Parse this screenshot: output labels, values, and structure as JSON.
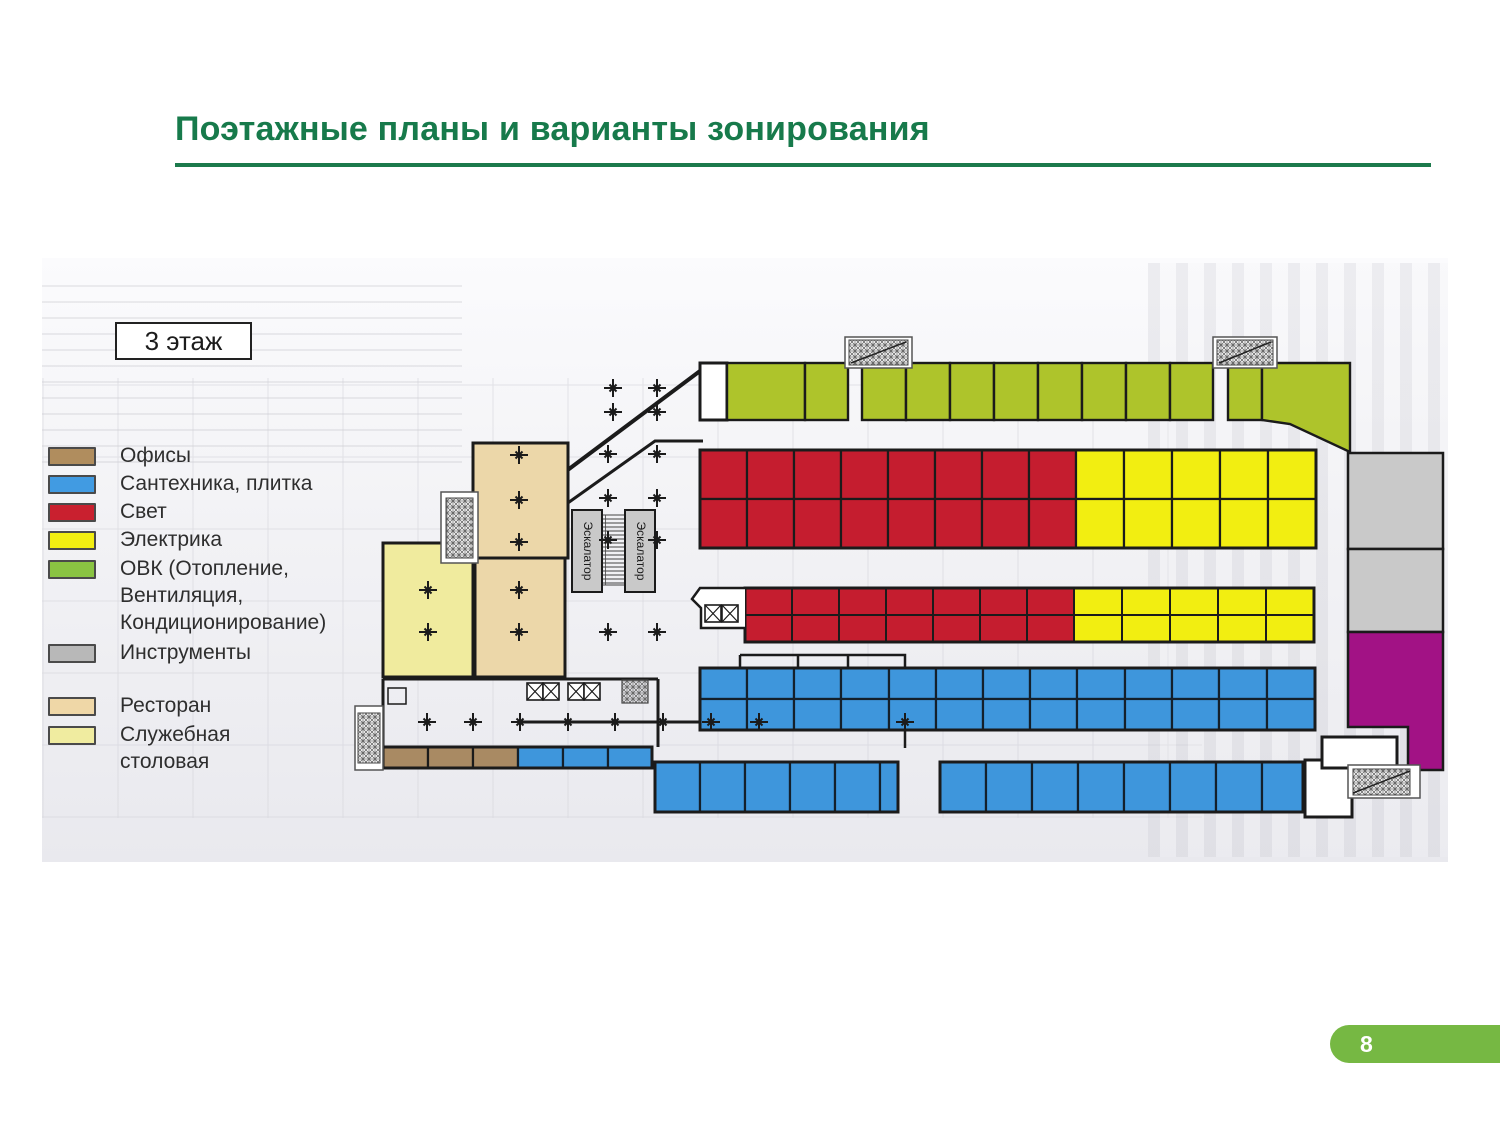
{
  "slide": {
    "title": "Поэтажные планы и варианты зонирования",
    "page_number": "8"
  },
  "plan": {
    "floor_label": "3 этаж",
    "escalators": [
      "Эскалатор",
      "Эскалатор"
    ]
  },
  "legend": {
    "items": [
      {
        "label": "Офисы",
        "color": "#b08d5e"
      },
      {
        "label": "Сантехника, плитка",
        "color": "#419be2"
      },
      {
        "label": "Свет",
        "color": "#c9202f"
      },
      {
        "label": "Электрика",
        "color": "#f2ee11"
      },
      {
        "label": "ОВК (Отопление,",
        "color": "#8ac442",
        "line2": "Вентиляция,",
        "line3": "Кондиционирование)"
      },
      {
        "label": "Инструменты",
        "color": "#b8b8b8"
      },
      {
        "label": "Ресторан",
        "color": "#efd7a7"
      },
      {
        "label": "Служебная",
        "color": "#f0eca0",
        "line2": "столовая"
      }
    ]
  },
  "colors": {
    "hvac_green": "#aec42b",
    "light_red": "#c51d2f",
    "electric_yellow": "#f2ee11",
    "plumbing_blue": "#3e96dc",
    "office_brown": "#a98a63",
    "restaurant_beige": "#ecd7a9",
    "canteen_yellow": "#f0eb9e",
    "tools_gray": "#c9c9c9",
    "magenta_zone": "#a21285",
    "wall_black": "#1b1b1b"
  }
}
